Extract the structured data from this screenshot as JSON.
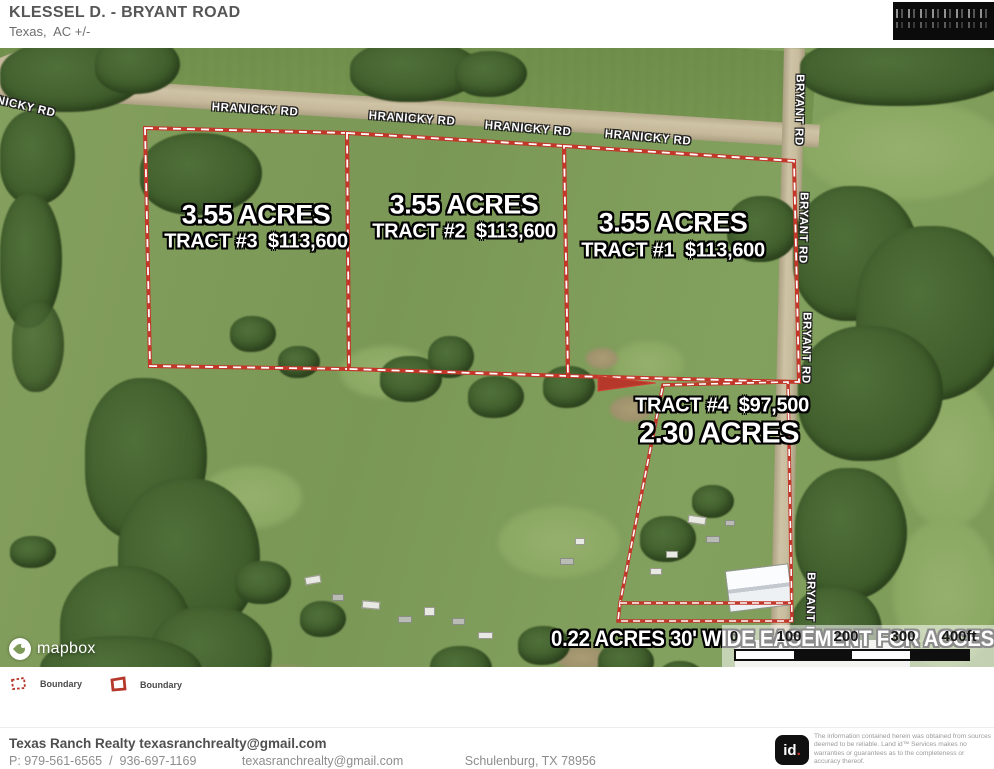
{
  "header": {
    "title": "KLESSEL D. - BRYANT ROAD",
    "subtitle": "Texas,  AC +/-"
  },
  "map": {
    "road_labels": {
      "hranicky": [
        "HRANICKY RD",
        "HRANICKY RD",
        "HRANICKY RD",
        "HRANICKY RD"
      ],
      "hranicky_partial": "ANICKY RD",
      "bryant": [
        "BRYANT RD",
        "BRYANT RD",
        "BRYANT RD",
        "BRYANT RD"
      ]
    },
    "tracts": [
      {
        "name": "tract-3",
        "acres": "3.55 ACRES",
        "detail": "TRACT #3  $113,600"
      },
      {
        "name": "tract-2",
        "acres": "3.55 ACRES",
        "detail": "TRACT #2  $113,600"
      },
      {
        "name": "tract-1",
        "acres": "3.55 ACRES",
        "detail": "TRACT #1  $113,600"
      },
      {
        "name": "tract-4",
        "acres": "2.30 ACRES",
        "detail": "TRACT #4  $97,500"
      }
    ],
    "easement_label": "0.22 ACRES 30' WIDE EASEMENT FOR ACCESS",
    "scale_bar": {
      "ticks": [
        "0",
        "100",
        "200",
        "300",
        "400ft"
      ]
    },
    "attribution": "mapbox"
  },
  "legend": {
    "items": [
      {
        "label": "Boundary",
        "style": "dashed"
      },
      {
        "label": "Boundary",
        "style": "solid"
      }
    ]
  },
  "footer": {
    "company_line": "Texas Ranch Realty texasranchrealty@gmail.com",
    "phone": "P: 979-561-6565  /  936-697-1169",
    "email": "texasranchrealty@gmail.com",
    "address": "Schulenburg, TX 78956",
    "id_logo": {
      "text": "id",
      "dot": "."
    },
    "disclaimer_line1": "The information contained herein was obtained from sources deemed to be reliable. ",
    "disclaimer_line2": "Land id™ Services makes no warranties or guarantees as to the completeness or accuracy thereof."
  },
  "colors": {
    "boundary_red": "#c2372a",
    "field_green": "#7d9a58",
    "tree_green": "#3c5a28",
    "road_tan": "#cfc3a6"
  }
}
